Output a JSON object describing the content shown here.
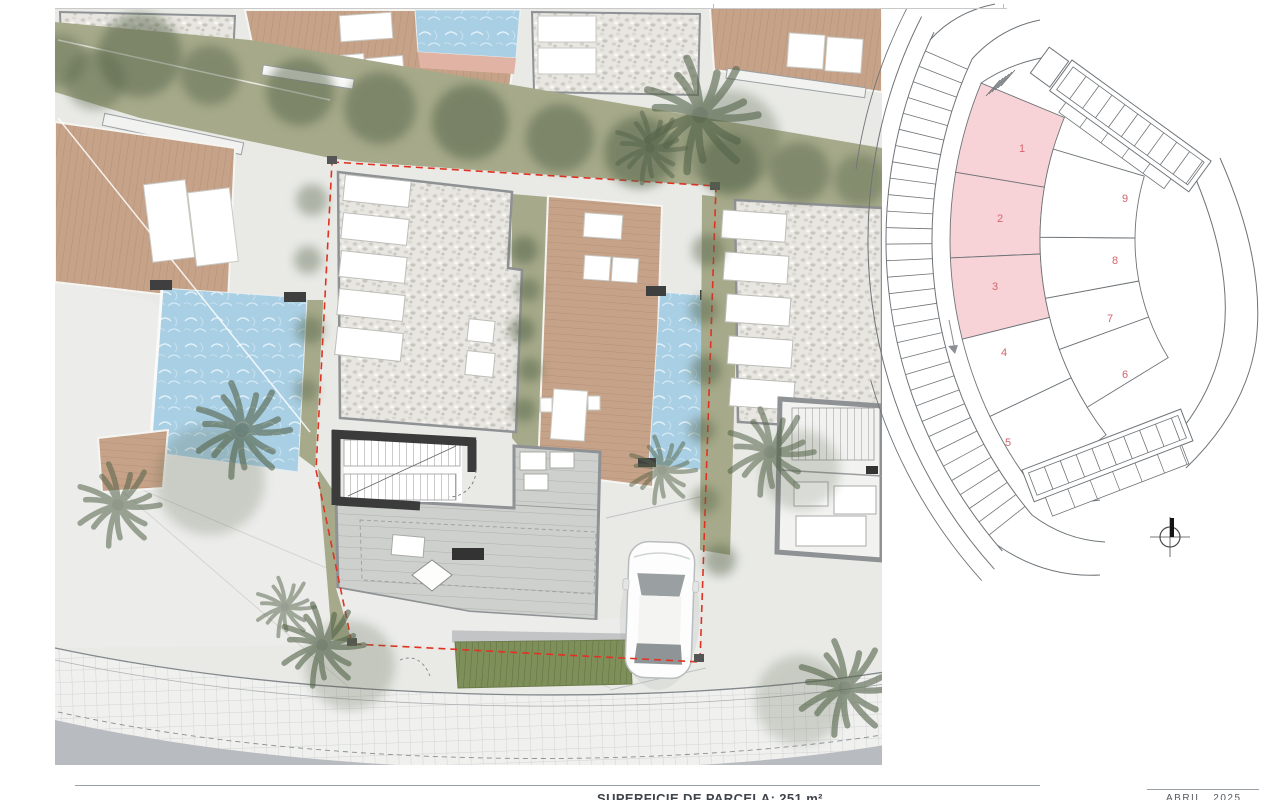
{
  "footer": {
    "area_label": "SUPERFICIE DE PARCELA: 251 m²",
    "date_label": "ABRIL 2025"
  },
  "key_plan": {
    "parcels": [
      {
        "label": "1",
        "highlighted": true
      },
      {
        "label": "2",
        "highlighted": true
      },
      {
        "label": "3",
        "highlighted": true
      },
      {
        "label": "4",
        "highlighted": false
      },
      {
        "label": "5",
        "highlighted": false
      },
      {
        "label": "6",
        "highlighted": false
      },
      {
        "label": "7",
        "highlighted": false
      },
      {
        "label": "8",
        "highlighted": false
      },
      {
        "label": "9",
        "highlighted": false
      }
    ],
    "colors": {
      "highlight": "#f7d3d8",
      "number": "#d4646c",
      "line": "#6f7478"
    }
  },
  "site_plan": {
    "colors": {
      "pool": "#a9cfe4",
      "pool_edge": "#e0b3a4",
      "deck": "#c6a288",
      "lawn": "#a6aa8a",
      "tree": "#55644a",
      "gravel": "#e8e6e1",
      "paving": "#e9eae6",
      "plaza": "#ececea",
      "road": "#b8bbbf",
      "cobble": "#f0f0ee",
      "tile": "#cdd0cc",
      "wall_dark": "#3b3b3b",
      "wall_gray": "#8f9295",
      "boundary": "#e03222",
      "hedge": "#7f8f5a"
    }
  }
}
